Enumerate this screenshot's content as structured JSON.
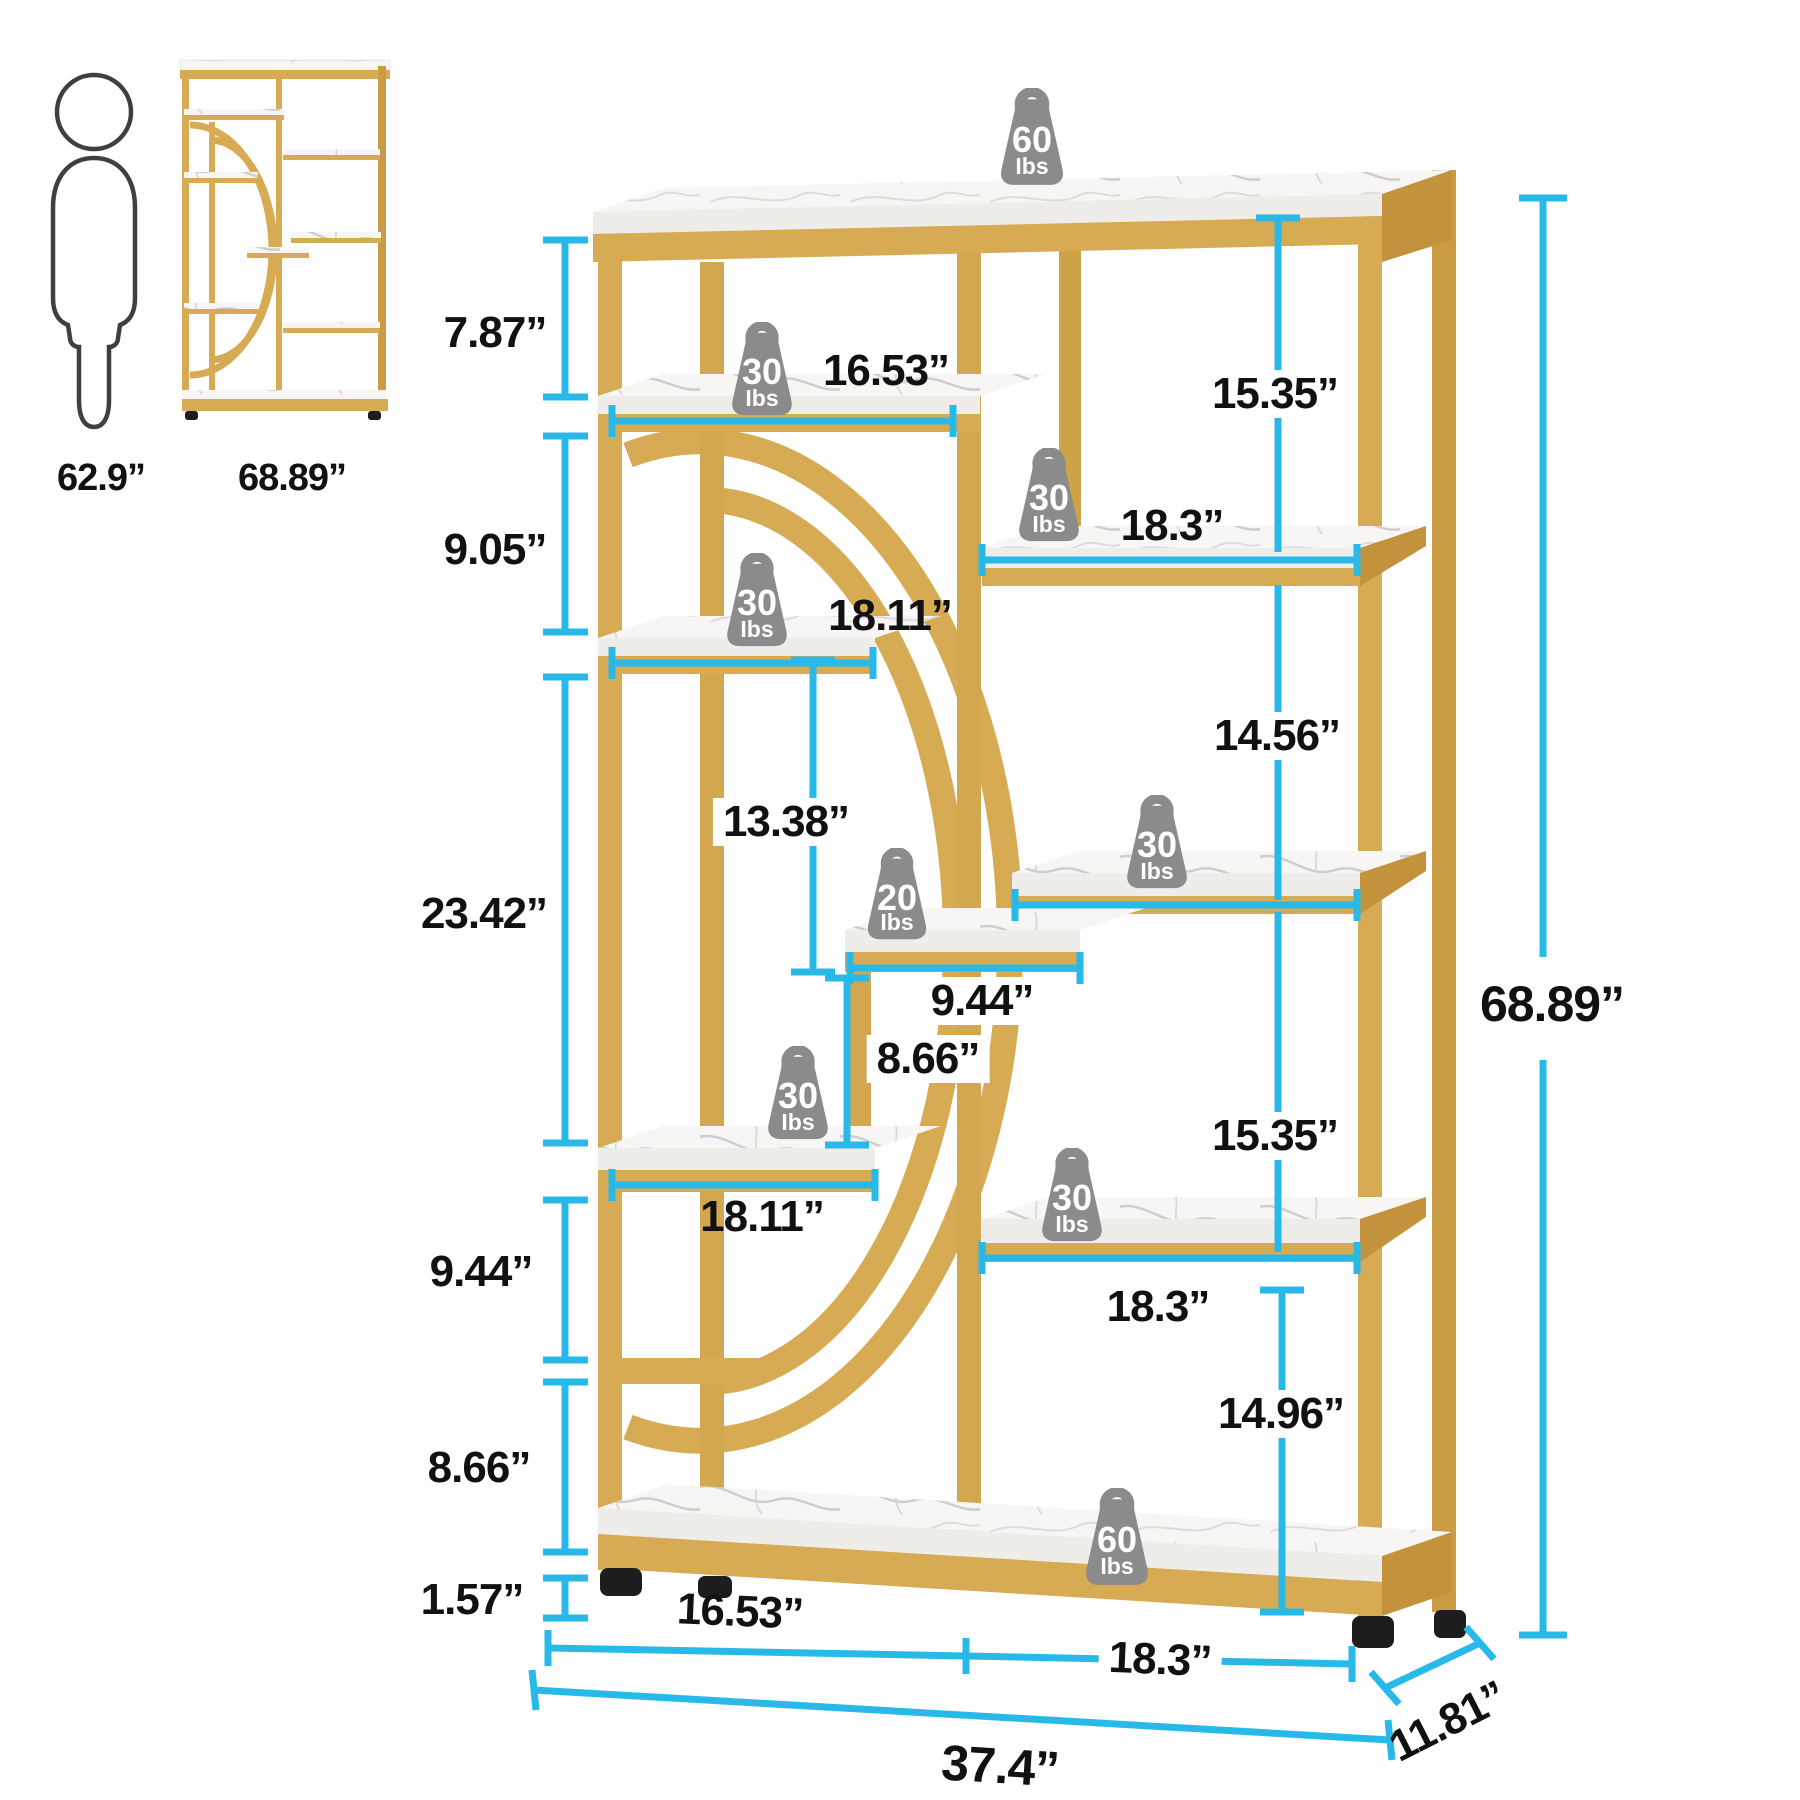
{
  "colors": {
    "accent_cyan": "#29b9e8",
    "gold_front": "#d6ab53",
    "gold_light": "#e3bf70",
    "gold_dark": "#c2923c",
    "marble": "#f7f6f4",
    "weight_grey": "#8b8b8b",
    "label_text": "#111111"
  },
  "reference": {
    "person_height": "62.9”",
    "shelf_total_height": "68.89”"
  },
  "labels": {
    "left": {
      "a": "7.87”",
      "b": "9.05”",
      "c": "23.42”",
      "d": "9.44”",
      "e": "8.66”",
      "f": "1.57”"
    },
    "middle": {
      "shelf_top": "16.53”",
      "shelf_upper": "18.11”",
      "inner_height": "13.38”",
      "shelf_small": "9.44”",
      "inner_height2": "8.66”",
      "shelf_lower": "18.11”"
    },
    "right": {
      "a": "15.35”",
      "b": "18.3”",
      "c": "14.56”",
      "d": "15.35”",
      "e": "18.3”",
      "f": "14.96”",
      "total_height": "68.89”"
    },
    "bottom": {
      "left_section": "16.53”",
      "right_section": "18.3”",
      "total_width": "37.4”",
      "depth": "11.81”"
    }
  },
  "weights": {
    "top": {
      "value": "60",
      "unit": "Ibs"
    },
    "a": {
      "value": "30",
      "unit": "Ibs"
    },
    "b": {
      "value": "30",
      "unit": "Ibs"
    },
    "c": {
      "value": "30",
      "unit": "Ibs"
    },
    "mid20": {
      "value": "20",
      "unit": "Ibs"
    },
    "d": {
      "value": "30",
      "unit": "Ibs"
    },
    "e": {
      "value": "30",
      "unit": "Ibs"
    },
    "f": {
      "value": "30",
      "unit": "Ibs"
    },
    "bottom": {
      "value": "60",
      "unit": "Ibs"
    }
  }
}
